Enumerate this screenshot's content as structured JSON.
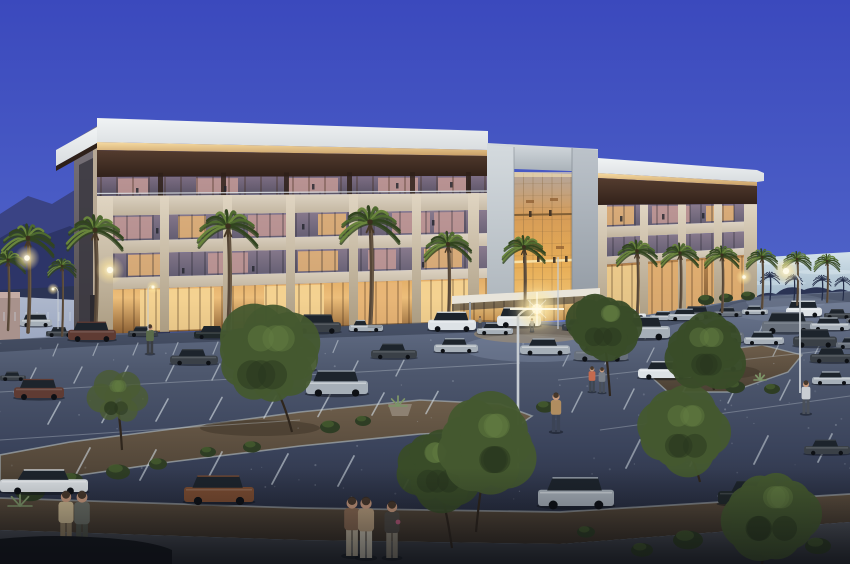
{
  "scene": {
    "description": "Dusk architectural rendering of a four-story office building with a lit central glass atrium, palm-lined facade, landscaped parking lot filled with cars, street lamps glowing, pedestrians on the sidewalk, mountains on the left horizon",
    "time_of_day": "dusk",
    "building_floors": 4,
    "setting": "suburban office park"
  },
  "palette": {
    "skyTop": "#3b49bd",
    "skyMid": "#4f63c8",
    "skyLow": "#8099d2",
    "skyHorizon": "#bdd2e2",
    "horizHi": "#d3e2ea",
    "horizLo": "#9db4c6",
    "treelineDark": "#2b3454",
    "mountainBack": "#3a4384",
    "mountainFront": "#2d3568",
    "roadHi": "#aeb8cc",
    "roadLo": "#96a2be",
    "wall": "#a8928c",
    "wallTop": "#c4aca4",
    "fasciaHi": "#f0f3f4",
    "fasciaLo": "#d9dde0",
    "glowHi": "#f6dba2",
    "glowLo": "#c79e66",
    "brownHi": "#543c2f",
    "brownLo": "#32221a",
    "fin": "#2e2019",
    "slabHi": "#ded4c4",
    "slabLo": "#bfb29c",
    "glassHi": "#8a7b8e",
    "glassLo": "#615c70",
    "f4Hi": "#7e6e84",
    "f4Lo": "#575264",
    "storeHi": "#e2ad66",
    "storeMid": "#edbe7a",
    "storeLo": "#8a5f33",
    "store2Hi": "#bb8850",
    "store2Lo": "#6b4e2e",
    "pierHi": "#e0d5c2",
    "pierLo": "#ab9c82",
    "sideHi": "#7a747c",
    "sideLo": "#4f4a4b",
    "sideWin": "#3a3740",
    "sideEdge": "#b8a995",
    "jambHi": "#d4dade",
    "jambLo": "#a9b1b8",
    "jamb2Hi": "#bcc3ca",
    "jamb2Lo": "#8f97a0",
    "atg0": "#b3a69e",
    "atg1": "#d69c57",
    "atg2": "#e7ad56",
    "atg3": "#f2cb80",
    "lobbyHi": "#f4d492",
    "lobbyLo": "#bb8443",
    "canopy": "#e8e4da",
    "railing": "#d8dde0",
    "litW": "#e7b577",
    "litP": "#c49a97",
    "litBright": "#f6d695",
    "mullion": "#14161e",
    "mullionWarm": "#3a2412",
    "lotTop": "#6e7a93",
    "lot1": "#4e586e",
    "lot2": "#3a435b",
    "lotBottom": "#272d3f",
    "stripe": "#cdd6dd",
    "curb": "#9aa1a5",
    "gravelHi": "#6e5e4b",
    "gravelLo": "#4b4034",
    "gravel2Hi": "#5c4e3e",
    "gravel2Lo": "#3b3228",
    "walkHi": "#4c5057",
    "walkLo": "#2c2f35",
    "walkSide": "#9aa3b0",
    "shadow": "#141a28",
    "lampCore": "#fffbe8",
    "lampGlow": "#ffe79e",
    "halo": "#ffedb2",
    "sheen": "#93a0b8",
    "poolWarm": "#caa45e",
    "trunk": "#554637",
    "trunkHi": "#6e5c48",
    "palmDark": "#31441f",
    "palmMain": "#4e6a2f",
    "palmLite": "#69853c",
    "palmCore": "#3a2f1e",
    "palmSil": "#232c48",
    "skirt": "#473826",
    "treeM": "#44592f",
    "treeD": "#394c28",
    "treeS": "#4a5c33",
    "treeShade": "#27361e",
    "treeLite": "#647e42",
    "shrub": "#2e3d24",
    "shrubLite": "#486031",
    "agave": "#7d9468",
    "pot": "#8d8172",
    "skin": "#c89a7e",
    "carW": "#dde2e6",
    "carS": "#a6afb8",
    "carG": "#68707c",
    "carD": "#3a4047",
    "carK": "#20282a",
    "carM": "#5f3b33",
    "carB": "#7b4c31",
    "carGlass": "#1d242c",
    "wheel": "#0d1015",
    "carShadow": "#10141c",
    "blob": "#15181d",
    "vign": "#080a10",
    "doorDark": "#2c2a30"
  },
  "palms": {
    "main": [
      [
        28,
        238,
        332,
        1.0
      ],
      [
        95,
        230,
        334,
        1.08
      ],
      [
        228,
        226,
        332,
        1.15
      ],
      [
        370,
        222,
        330,
        1.15
      ],
      [
        448,
        244,
        326,
        0.9
      ],
      [
        524,
        247,
        322,
        0.82
      ],
      [
        637,
        251,
        318,
        0.78
      ],
      [
        680,
        253,
        315,
        0.72
      ],
      [
        722,
        255,
        312,
        0.66
      ],
      [
        762,
        257,
        308,
        0.6
      ],
      [
        797,
        259,
        305,
        0.55
      ],
      [
        827,
        261,
        302,
        0.5
      ],
      [
        8,
        260,
        330,
        0.68
      ],
      [
        62,
        266,
        336,
        0.55
      ]
    ],
    "silhouette": [
      [
        770,
        277,
        300,
        0.38
      ],
      [
        794,
        279,
        300,
        0.34
      ],
      [
        822,
        280,
        300,
        0.36
      ],
      [
        843,
        281,
        300,
        0.32
      ]
    ]
  },
  "trees": {
    "mid": [
      [
        268,
        358,
        56,
        292,
        432,
        "m"
      ],
      [
        604,
        326,
        36,
        610,
        396,
        "d"
      ],
      [
        684,
        432,
        46,
        700,
        482,
        "m"
      ],
      [
        704,
        352,
        42,
        714,
        390,
        "d"
      ],
      [
        118,
        398,
        34,
        122,
        450,
        "s"
      ]
    ],
    "front": [
      [
        438,
        468,
        44,
        452,
        548,
        "d"
      ],
      [
        486,
        444,
        52,
        476,
        532,
        "m"
      ],
      [
        772,
        514,
        48,
        762,
        564,
        "m"
      ]
    ]
  },
  "shrubs": [
    [
      30,
      492,
      15
    ],
    [
      72,
      480,
      11
    ],
    [
      118,
      472,
      12
    ],
    [
      158,
      464,
      9
    ],
    [
      330,
      427,
      10
    ],
    [
      363,
      421,
      8
    ],
    [
      545,
      407,
      9
    ],
    [
      735,
      387,
      10
    ],
    [
      772,
      389,
      8
    ],
    [
      688,
      540,
      15
    ],
    [
      642,
      550,
      11
    ],
    [
      818,
      546,
      13
    ],
    [
      586,
      532,
      9
    ],
    [
      252,
      447,
      9
    ],
    [
      208,
      452,
      8
    ],
    [
      706,
      300,
      8
    ],
    [
      726,
      298,
      7
    ],
    [
      748,
      296,
      7
    ]
  ],
  "agaves": [
    [
      398,
      406,
      9
    ],
    [
      20,
      506,
      12
    ],
    [
      760,
      380,
      6
    ]
  ],
  "cars": {
    "back": [
      [
        20,
        326,
        32,
        "suv",
        "S"
      ],
      [
        46,
        336,
        28,
        "sed",
        "D"
      ],
      [
        620,
        318,
        26,
        "sed",
        "W"
      ],
      [
        650,
        320,
        28,
        "sed",
        "S"
      ],
      [
        682,
        318,
        30,
        "suv",
        "D"
      ],
      [
        714,
        316,
        28,
        "sed",
        "G"
      ],
      [
        742,
        314,
        26,
        "sed",
        "S"
      ],
      [
        786,
        316,
        36,
        "van",
        "W"
      ],
      [
        824,
        318,
        28,
        "sed",
        "D"
      ],
      [
        846,
        322,
        22,
        "sed",
        "G"
      ]
    ],
    "rowA": [
      [
        68,
        340,
        48,
        "suv",
        "M"
      ],
      [
        128,
        336,
        30,
        "sed",
        "D"
      ],
      [
        194,
        338,
        38,
        "sed",
        "K"
      ],
      [
        242,
        336,
        40,
        "sed",
        "D"
      ],
      [
        295,
        332,
        46,
        "suv",
        "D"
      ],
      [
        349,
        331,
        34,
        "pik",
        "S"
      ],
      [
        428,
        330,
        48,
        "suv",
        "W"
      ],
      [
        477,
        334,
        36,
        "sed",
        "S"
      ],
      [
        497,
        326,
        44,
        "van",
        "W"
      ],
      [
        562,
        330,
        34,
        "sed",
        "D"
      ],
      [
        598,
        328,
        32,
        "sed",
        "G"
      ],
      [
        668,
        320,
        36,
        "sed",
        "S"
      ],
      [
        614,
        338,
        56,
        "suv",
        "S"
      ],
      [
        698,
        342,
        46,
        "suv",
        "G"
      ],
      [
        762,
        332,
        52,
        "suv",
        "G"
      ],
      [
        810,
        330,
        40,
        "sed",
        "S"
      ],
      [
        744,
        344,
        40,
        "sed",
        "S"
      ],
      [
        793,
        346,
        44,
        "suv",
        "D"
      ],
      [
        836,
        348,
        34,
        "sed",
        "G"
      ],
      [
        810,
        362,
        46,
        "sed",
        "D"
      ]
    ],
    "mid": [
      [
        0,
        380,
        26,
        "sed",
        "D"
      ],
      [
        14,
        398,
        50,
        "suv",
        "M"
      ],
      [
        170,
        364,
        48,
        "sed",
        "D"
      ],
      [
        256,
        370,
        60,
        "suv",
        "W"
      ],
      [
        306,
        394,
        62,
        "suv",
        "S"
      ],
      [
        371,
        358,
        46,
        "sed",
        "D"
      ],
      [
        434,
        352,
        44,
        "sed",
        "S"
      ],
      [
        520,
        354,
        50,
        "sed",
        "S"
      ],
      [
        574,
        360,
        54,
        "sed",
        "G"
      ],
      [
        638,
        378,
        54,
        "sed",
        "W"
      ],
      [
        698,
        370,
        44,
        "suv",
        "G"
      ],
      [
        812,
        384,
        40,
        "sed",
        "S"
      ]
    ],
    "front": [
      [
        0,
        492,
        88,
        "cou",
        "W"
      ],
      [
        184,
        502,
        70,
        "suv",
        "B"
      ],
      [
        538,
        506,
        76,
        "suv",
        "S"
      ],
      [
        718,
        504,
        74,
        "sed",
        "K"
      ],
      [
        804,
        454,
        46,
        "sed",
        "D"
      ]
    ]
  },
  "people": {
    "mid": [
      [
        150,
        354,
        30,
        "#5a6b4a",
        "#3a3d42"
      ],
      [
        556,
        432,
        40,
        "#b08d60",
        "#3c4456"
      ],
      [
        592,
        392,
        26,
        "#c46a4e",
        "#3e4650"
      ],
      [
        602,
        393,
        26,
        "#7a8088",
        "#474e58"
      ],
      [
        806,
        414,
        34,
        "#c9cdd2",
        "#4a505a"
      ],
      [
        532,
        332,
        14,
        "#8a8f96",
        "#3f444c"
      ],
      [
        480,
        328,
        12,
        "#9a8a6e",
        "#42464e"
      ]
    ],
    "front": [
      [
        66,
        548,
        58,
        "#c9b790",
        "#8a7a5e"
      ],
      [
        82,
        550,
        60,
        "#6b6f66",
        "#4e5248"
      ],
      [
        352,
        556,
        60,
        "#8a6a52",
        "#bfb49c"
      ],
      [
        366,
        558,
        62,
        "#b99f7e",
        "#c9c2b0"
      ],
      [
        392,
        558,
        58,
        "#4e4a44",
        "#8f8878"
      ]
    ]
  },
  "street_lights": [
    {
      "x": 518,
      "t": 316,
      "b": 468,
      "lx": 537,
      "ly": 309,
      "s": 1.7,
      "w": 2.6,
      "flare": true
    },
    {
      "x": 800,
      "t": 281,
      "b": 393,
      "lx": 786,
      "ly": 271,
      "s": 1.05,
      "w": 1.8
    },
    {
      "x": 148,
      "t": 289,
      "b": 331,
      "lx": 153,
      "ly": 287,
      "s": 0.5,
      "w": 1
    },
    {
      "x": 58,
      "t": 291,
      "b": 329,
      "lx": 53,
      "ly": 289,
      "s": 0.45,
      "w": 1
    },
    {
      "x": 558,
      "t": 257,
      "b": 329,
      "s": 0,
      "w": 1.2
    }
  ],
  "glow_dots": [
    [
      27,
      258,
      8
    ],
    [
      110,
      270,
      9
    ],
    [
      744,
      277,
      5
    ]
  ],
  "lit_windows": [
    {
      "f": "f4",
      "x": 118,
      "w": 30,
      "t": "p"
    },
    {
      "f": "f4",
      "x": 196,
      "w": 42,
      "t": "p"
    },
    {
      "f": "f4",
      "x": 288,
      "w": 50,
      "t": "p"
    },
    {
      "f": "f4",
      "x": 378,
      "w": 40,
      "t": "p"
    },
    {
      "f": "f4",
      "x": 438,
      "w": 28,
      "t": "p"
    },
    {
      "f": "f3",
      "x": 112,
      "w": 40,
      "t": "p"
    },
    {
      "f": "f3",
      "x": 178,
      "w": 28,
      "t": "w"
    },
    {
      "f": "f3",
      "x": 248,
      "w": 44,
      "t": "p"
    },
    {
      "f": "f3",
      "x": 318,
      "w": 28,
      "t": "w"
    },
    {
      "f": "f3",
      "x": 392,
      "w": 38,
      "t": "p"
    },
    {
      "f": "f3",
      "x": 434,
      "w": 30,
      "t": "p"
    },
    {
      "f": "f2",
      "x": 128,
      "w": 34,
      "t": "w"
    },
    {
      "f": "f2",
      "x": 208,
      "w": 40,
      "t": "p"
    },
    {
      "f": "f2",
      "x": 298,
      "w": 40,
      "t": "w"
    },
    {
      "f": "f2",
      "x": 368,
      "w": 28,
      "t": "p"
    },
    {
      "f": "f2",
      "x": 424,
      "w": 38,
      "t": "w"
    },
    {
      "f": "g",
      "x": 140,
      "w": 74,
      "t": "W"
    },
    {
      "f": "g",
      "x": 264,
      "w": 60,
      "t": "W"
    },
    {
      "f": "g",
      "x": 352,
      "w": 50,
      "t": "w"
    },
    {
      "f": "g",
      "x": 414,
      "w": 62,
      "t": "W"
    },
    {
      "f": "ra",
      "x": 606,
      "w": 28,
      "t": "w"
    },
    {
      "f": "ra",
      "x": 652,
      "w": 38,
      "t": "p"
    },
    {
      "f": "ra",
      "x": 706,
      "w": 28,
      "t": "w"
    },
    {
      "f": "rg",
      "x": 600,
      "w": 42,
      "t": "W"
    },
    {
      "f": "rg",
      "x": 648,
      "w": 56,
      "t": "w"
    },
    {
      "f": "rg",
      "x": 708,
      "w": 36,
      "t": "w"
    }
  ],
  "window_people": [
    [
      136,
      188
    ],
    [
      224,
      186
    ],
    [
      312,
      184
    ],
    [
      396,
      183
    ],
    [
      450,
      182
    ],
    [
      156,
      228
    ],
    [
      302,
      224
    ],
    [
      432,
      220
    ],
    [
      182,
      268
    ],
    [
      252,
      266
    ],
    [
      422,
      262
    ],
    [
      620,
      216
    ],
    [
      662,
      214
    ],
    [
      702,
      213
    ]
  ],
  "atrium_people": [
    [
      523,
      257
    ],
    [
      537,
      256
    ],
    [
      553,
      257
    ],
    [
      565,
      256
    ],
    [
      529,
      211
    ],
    [
      549,
      210
    ]
  ],
  "stripe_rows": [
    {
      "x0": 58,
      "y0": 344,
      "n": 8,
      "sx": 40,
      "sy": -0.5,
      "dx": -5,
      "dy": 12,
      "w": 1.2,
      "o": 0.55
    },
    {
      "x0": 612,
      "y0": 330,
      "n": 6,
      "sx": 38,
      "sy": -2,
      "dx": -5,
      "dy": 11,
      "w": 1.2,
      "o": 0.5
    },
    {
      "x0": 36,
      "y0": 368,
      "n": 9,
      "sx": 46,
      "sy": -1,
      "dx": -8,
      "dy": 16,
      "w": 1.4,
      "o": 0.6
    },
    {
      "x0": 570,
      "y0": 352,
      "n": 7,
      "sx": 42,
      "sy": -2,
      "dx": -7,
      "dy": 14,
      "w": 1.3,
      "o": 0.55
    },
    {
      "x0": 60,
      "y0": 402,
      "n": 8,
      "sx": 54,
      "sy": -1.5,
      "dx": -12,
      "dy": 22,
      "w": 1.6,
      "o": 0.65
    },
    {
      "x0": 582,
      "y0": 392,
      "n": 5,
      "sx": 52,
      "sy": -3,
      "dx": -10,
      "dy": 20,
      "w": 1.5,
      "o": 0.6
    },
    {
      "x0": 90,
      "y0": 448,
      "n": 6,
      "sx": 66,
      "sy": 2,
      "dx": -16,
      "dy": 30,
      "w": 1.8,
      "o": 0.6
    },
    {
      "x0": 640,
      "y0": 440,
      "n": 4,
      "sx": 64,
      "sy": -2,
      "dx": -14,
      "dy": 28,
      "w": 1.8,
      "o": 0.55
    }
  ],
  "lane_lines": [
    [
      0,
      392,
      520,
      363
    ],
    [
      0,
      440,
      300,
      420
    ],
    [
      558,
      380,
      850,
      348
    ],
    [
      600,
      430,
      850,
      396
    ]
  ]
}
